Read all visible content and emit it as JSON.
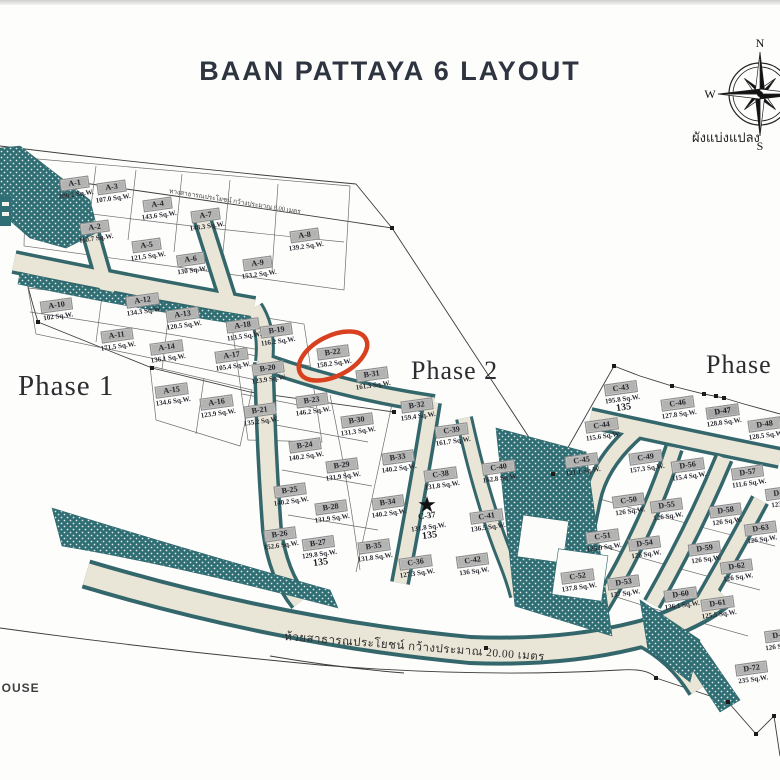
{
  "title": "BAAN PATTAYA 6 LAYOUT",
  "phases": [
    {
      "label": "Phase 1"
    },
    {
      "label": "Phase 2"
    },
    {
      "label": "Phase 3"
    }
  ],
  "compass": {
    "n": "N",
    "e": "E",
    "s": "S",
    "w": "W"
  },
  "labels": {
    "plan_caption": "ผังแบ่งแปลง",
    "house": "HOUSE"
  },
  "roads": {
    "top_road_label": "ทางสาธารณประโยชน์ กว้างประมาณ 8.00 เมตร",
    "bottom_road_label": "ห้วยสาธารณประโยชน์ กว้างประมาณ 20.00 เมตร"
  },
  "highlight": {
    "lot": "B-22",
    "shape": "red-oval",
    "color": "#d8411f"
  },
  "star_marker_lot": "C-37",
  "unit": "Sq.W.",
  "lots": [
    {
      "id": "A-1",
      "size": "200.2 Sq.W.",
      "x": 75,
      "y": 186
    },
    {
      "id": "A-3",
      "size": "107.0 Sq.W.",
      "x": 112,
      "y": 190
    },
    {
      "id": "A-4",
      "size": "143.6 Sq.W.",
      "x": 158,
      "y": 207
    },
    {
      "id": "A-7",
      "size": "148.3 Sq.W.",
      "x": 206,
      "y": 218
    },
    {
      "id": "A-2",
      "size": "110.7 Sq.W.",
      "x": 95,
      "y": 230
    },
    {
      "id": "A-5",
      "size": "121.5 Sq.W.",
      "x": 147,
      "y": 248
    },
    {
      "id": "A-6",
      "size": "130 Sq.W.",
      "x": 191,
      "y": 262
    },
    {
      "id": "A-8",
      "size": "139.2 Sq.W.",
      "x": 305,
      "y": 238
    },
    {
      "id": "A-9",
      "size": "153.2 Sq.W.",
      "x": 258,
      "y": 266
    },
    {
      "id": "A-10",
      "size": "102 Sq.W.",
      "x": 57,
      "y": 308
    },
    {
      "id": "A-12",
      "size": "134.3 Sq.W.",
      "x": 143,
      "y": 303
    },
    {
      "id": "A-13",
      "size": "120.5 Sq.W.",
      "x": 183,
      "y": 317
    },
    {
      "id": "A-11",
      "size": "171.5 Sq.W.",
      "x": 117,
      "y": 338
    },
    {
      "id": "A-14",
      "size": "136.1 Sq.W.",
      "x": 167,
      "y": 350
    },
    {
      "id": "A-15",
      "size": "134.6 Sq.W.",
      "x": 172,
      "y": 393
    },
    {
      "id": "A-16",
      "size": "123.9 Sq.W.",
      "x": 217,
      "y": 405
    },
    {
      "id": "A-17",
      "size": "105.4 Sq.W.",
      "x": 232,
      "y": 358
    },
    {
      "id": "A-18",
      "size": "113.5 Sq.W.",
      "x": 243,
      "y": 328
    },
    {
      "id": "B-19",
      "size": "116.2 Sq.W.",
      "x": 277,
      "y": 333
    },
    {
      "id": "B-20",
      "size": "123.9 Sq.W.",
      "x": 268,
      "y": 371
    },
    {
      "id": "B-21",
      "size": "135.2 Sq.W.",
      "x": 260,
      "y": 413
    },
    {
      "id": "B-22",
      "size": "158.2 Sq.W.",
      "x": 333,
      "y": 355,
      "highlighted": true
    },
    {
      "id": "B-31",
      "size": "161.3 Sq.W.",
      "x": 372,
      "y": 377
    },
    {
      "id": "B-23",
      "size": "146.2 Sq.W.",
      "x": 312,
      "y": 403
    },
    {
      "id": "B-30",
      "size": "131.3 Sq.W.",
      "x": 357,
      "y": 423
    },
    {
      "id": "B-32",
      "size": "159.4 Sq.W.",
      "x": 417,
      "y": 408
    },
    {
      "id": "B-24",
      "size": "140.2 Sq.W.",
      "x": 305,
      "y": 448
    },
    {
      "id": "B-29",
      "size": "131.9 Sq.W.",
      "x": 342,
      "y": 468
    },
    {
      "id": "B-33",
      "size": "140.2 Sq.W.",
      "x": 398,
      "y": 460
    },
    {
      "id": "B-25",
      "size": "140.2 Sq.W.",
      "x": 290,
      "y": 493
    },
    {
      "id": "B-28",
      "size": "131.9 Sq.W.",
      "x": 331,
      "y": 510
    },
    {
      "id": "B-34",
      "size": "140.2 Sq.W.",
      "x": 388,
      "y": 505
    },
    {
      "id": "B-26",
      "size": "152.6 Sq.W.",
      "x": 280,
      "y": 537
    },
    {
      "id": "B-27",
      "size": "129.8 Sq.W.",
      "x": 319,
      "y": 551,
      "note": "135"
    },
    {
      "id": "B-35",
      "size": "131.8 Sq.W.",
      "x": 374,
      "y": 549
    },
    {
      "id": "C-36",
      "size": "127.3 Sq.W.",
      "x": 416,
      "y": 565
    },
    {
      "id": "C-37",
      "size": "131.8 Sq.W.",
      "x": 428,
      "y": 524,
      "plain": true,
      "note": "135"
    },
    {
      "id": "C-38",
      "size": "131.8 Sq.W.",
      "x": 441,
      "y": 477
    },
    {
      "id": "C-39",
      "size": "161.7 Sq.W.",
      "x": 452,
      "y": 433
    },
    {
      "id": "C-40",
      "size": "162.8 Sq.W.",
      "x": 499,
      "y": 470
    },
    {
      "id": "C-41",
      "size": "136.5 Sq.W.",
      "x": 487,
      "y": 519
    },
    {
      "id": "C-42",
      "size": "136 Sq.W.",
      "x": 473,
      "y": 563
    },
    {
      "id": "C-43",
      "size": "195.8 Sq.W.",
      "x": 622,
      "y": 396,
      "note": "135"
    },
    {
      "id": "C-46",
      "size": "127.8 Sq.W.",
      "x": 678,
      "y": 406
    },
    {
      "id": "D-47",
      "size": "128.8 Sq.W.",
      "x": 723,
      "y": 414,
      "bold": true
    },
    {
      "id": "D-48",
      "size": "128.5 Sq.W.",
      "x": 765,
      "y": 427
    },
    {
      "id": "C-44",
      "size": "115.6 Sq.W.",
      "x": 602,
      "y": 428
    },
    {
      "id": "C-45",
      "size": "121.1 Sq.W.",
      "x": 582,
      "y": 463
    },
    {
      "id": "C-49",
      "size": "157.3 Sq.W.",
      "x": 646,
      "y": 460
    },
    {
      "id": "D-56",
      "size": "115.4 Sq.W.",
      "x": 688,
      "y": 468
    },
    {
      "id": "D-57",
      "size": "111.6 Sq.W.",
      "x": 748,
      "y": 475
    },
    {
      "id": "D-",
      "size": "123.1",
      "x": 778,
      "y": 496
    },
    {
      "id": "C-50",
      "size": "126 Sq.W.",
      "x": 629,
      "y": 503
    },
    {
      "id": "D-55",
      "size": "126 Sq.W.",
      "x": 667,
      "y": 508
    },
    {
      "id": "D-58",
      "size": "126 Sq.W.",
      "x": 726,
      "y": 513
    },
    {
      "id": "D-63",
      "size": "126 Sq.W.",
      "x": 761,
      "y": 531
    },
    {
      "id": "C-51",
      "size": "125.9 Sq.W.",
      "x": 603,
      "y": 539
    },
    {
      "id": "D-54",
      "size": "126 Sq.W.",
      "x": 645,
      "y": 546
    },
    {
      "id": "D-59",
      "size": "126 Sq.W.",
      "x": 705,
      "y": 551
    },
    {
      "id": "D-62",
      "size": "126 Sq.W.",
      "x": 737,
      "y": 569
    },
    {
      "id": "C-52",
      "size": "137.8 Sq.W.",
      "x": 578,
      "y": 579
    },
    {
      "id": "D-53",
      "size": "137 Sq.W.",
      "x": 624,
      "y": 585
    },
    {
      "id": "D-60",
      "size": "136.1 Sq.W.",
      "x": 681,
      "y": 597
    },
    {
      "id": "D-61",
      "size": "125.5 Sq.W.",
      "x": 718,
      "y": 606
    },
    {
      "id": "D-7",
      "size": "126 Sq.W.",
      "x": 779,
      "y": 638
    },
    {
      "id": "D-72",
      "size": "235 Sq.W.",
      "x": 752,
      "y": 671
    }
  ]
}
